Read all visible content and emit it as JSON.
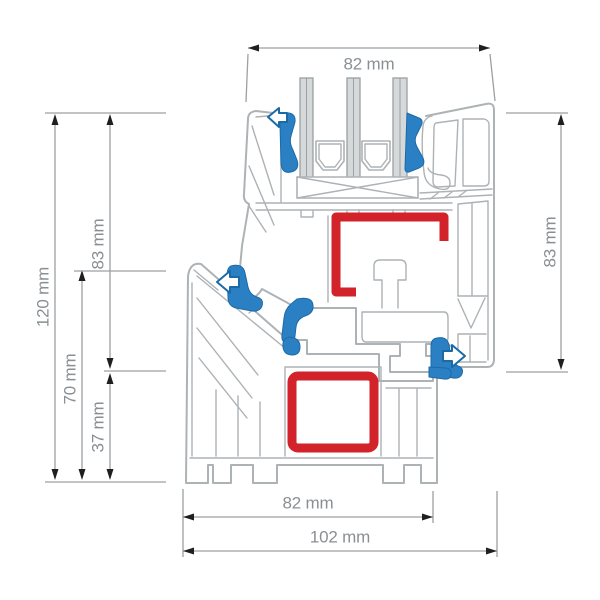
{
  "drawing": {
    "dimensions": {
      "top_width": "82 mm",
      "right_sash_height": "83 mm",
      "left_total_height": "120 mm",
      "left_sash_height": "83 mm",
      "left_frame_height": "70 mm",
      "left_bottom_height": "37 mm",
      "bottom_frame_width": "82 mm",
      "bottom_total_width": "102 mm"
    },
    "colors": {
      "steel_reinforcement": "#d2232a",
      "gasket": "#2b80c4",
      "gasket_dark": "#1b6aa8",
      "profile_line": "#adb2b5",
      "glass_fill": "#d5d9da",
      "glass_edge": "#9aa0a3",
      "dimension_line": "#9ba0a4",
      "dimension_text": "#8a8f93",
      "arrow": "#1f1f1f",
      "background": "#ffffff"
    }
  }
}
